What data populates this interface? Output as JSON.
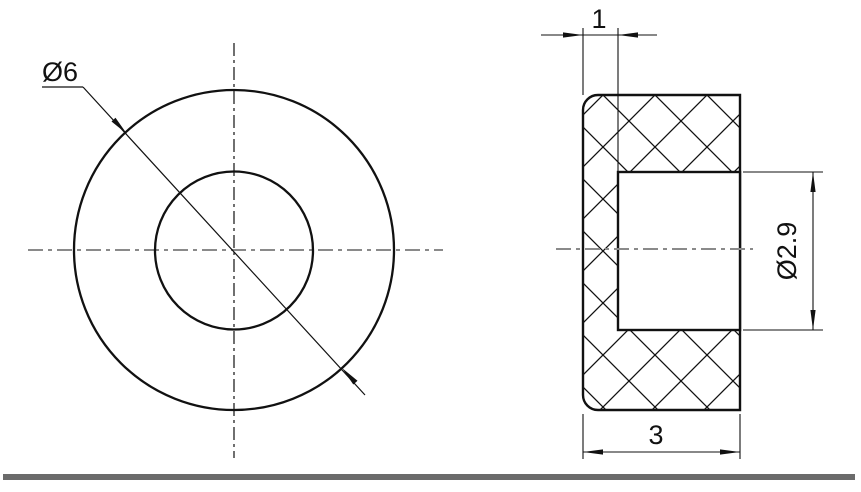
{
  "drawing": {
    "type": "technical-section-drawing",
    "front_view": {
      "outer_diameter_label": "Ø6"
    },
    "section_view": {
      "wall_thickness_label": "1",
      "bore_diameter_label": "Ø2.9",
      "overall_width_label": "3"
    },
    "colors": {
      "line": "#111111",
      "centerline": "#8a8a8a",
      "separator": "#6b6b6b",
      "background": "#ffffff"
    }
  }
}
